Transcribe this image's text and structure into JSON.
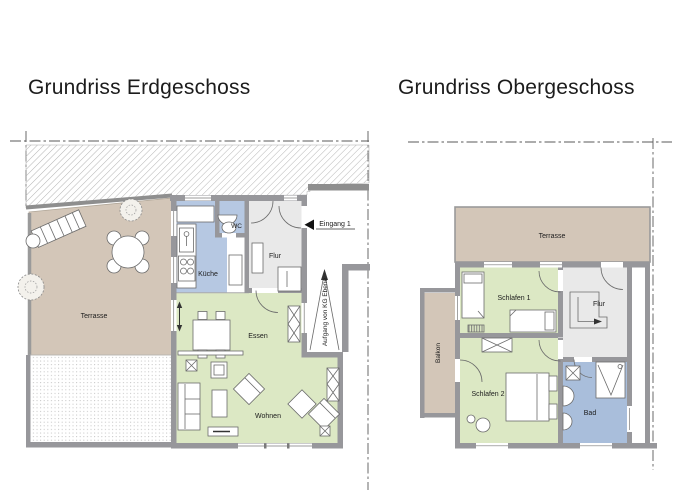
{
  "titles": {
    "gf": "Grundriss Erdgeschoss",
    "og": "Grundriss Obergeschoss"
  },
  "gf": {
    "terrasse": "Terrasse",
    "kueche": "Küche",
    "wc": "WC",
    "flur": "Flur",
    "essen": "Essen",
    "wohnen": "Wohnen",
    "eingang": "Eingang 1",
    "aufgang": "Aufgang von KG Ebene"
  },
  "og": {
    "terrasse": "Terrasse",
    "schlafen1": "Schlafen 1",
    "flur": "Flur",
    "schlafen2": "Schlafen 2",
    "bad": "Bad",
    "balkon": "Balkon"
  },
  "colors": {
    "wall": "#97979b",
    "terrace": "#d3c6b8",
    "green": "#dce8c4",
    "blue": "#b6c8e2",
    "badblue": "#a9bedb",
    "flurgray": "#e9e9e9",
    "dash": "#5a5a5a",
    "text": "#1c1c1c",
    "hatch": "#b5b5b5"
  }
}
